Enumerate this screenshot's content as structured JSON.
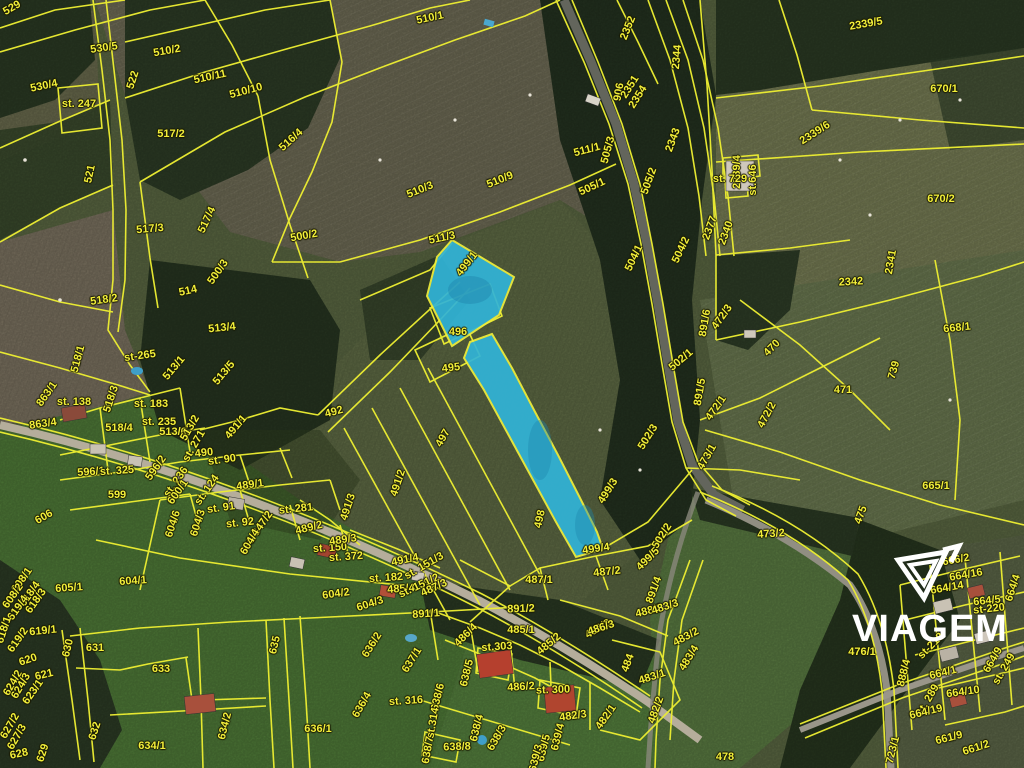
{
  "map": {
    "type": "cadastral-parcel-satellite-view",
    "watermark": {
      "brand": "VIAGEM",
      "color": "#ffffff"
    },
    "colors": {
      "boundary": "#edee32",
      "label": "#f2ef3a",
      "highlight_fill": "#31b4d8",
      "highlight_stroke": "#f0ef3c"
    },
    "highlighted_parcels": [
      "499/1",
      "499/3"
    ],
    "labels": [
      {
        "t": "529",
        "x": 12,
        "y": 8,
        "r": -30
      },
      {
        "t": "530/5",
        "x": 104,
        "y": 48,
        "r": -8
      },
      {
        "t": "510/2",
        "x": 167,
        "y": 51,
        "r": -10
      },
      {
        "t": "530/4",
        "x": 44,
        "y": 86,
        "r": -12
      },
      {
        "t": "st. 247",
        "x": 79,
        "y": 104,
        "r": 0
      },
      {
        "t": "522",
        "x": 133,
        "y": 80,
        "r": -72
      },
      {
        "t": "510/11",
        "x": 210,
        "y": 77,
        "r": -12
      },
      {
        "t": "510/10",
        "x": 246,
        "y": 91,
        "r": -15
      },
      {
        "t": "517/2",
        "x": 171,
        "y": 134,
        "r": 0
      },
      {
        "t": "516/4",
        "x": 291,
        "y": 140,
        "r": -42
      },
      {
        "t": "521",
        "x": 90,
        "y": 174,
        "r": -78
      },
      {
        "t": "517/3",
        "x": 150,
        "y": 229,
        "r": -5
      },
      {
        "t": "517/4",
        "x": 207,
        "y": 220,
        "r": -65
      },
      {
        "t": "500/2",
        "x": 304,
        "y": 236,
        "r": -10
      },
      {
        "t": "510/1",
        "x": 430,
        "y": 18,
        "r": -12
      },
      {
        "t": "2352",
        "x": 628,
        "y": 28,
        "r": -68
      },
      {
        "t": "906",
        "x": 619,
        "y": 92,
        "r": -80
      },
      {
        "t": "2351",
        "x": 630,
        "y": 87,
        "r": -58
      },
      {
        "t": "2354",
        "x": 638,
        "y": 97,
        "r": -58
      },
      {
        "t": "2344",
        "x": 677,
        "y": 57,
        "r": -85
      },
      {
        "t": "2343",
        "x": 673,
        "y": 140,
        "r": -70
      },
      {
        "t": "2339/5",
        "x": 866,
        "y": 24,
        "r": -10
      },
      {
        "t": "670/1",
        "x": 944,
        "y": 89,
        "r": 0
      },
      {
        "t": "2339/6",
        "x": 815,
        "y": 133,
        "r": -33
      },
      {
        "t": "2339/4",
        "x": 737,
        "y": 172,
        "r": -90
      },
      {
        "t": "st. 729",
        "x": 730,
        "y": 179,
        "r": 0
      },
      {
        "t": "st.646",
        "x": 753,
        "y": 180,
        "r": -90
      },
      {
        "t": "670/2",
        "x": 941,
        "y": 199,
        "r": 0
      },
      {
        "t": "510/3",
        "x": 420,
        "y": 190,
        "r": -22
      },
      {
        "t": "510/9",
        "x": 500,
        "y": 180,
        "r": -22
      },
      {
        "t": "511/3",
        "x": 442,
        "y": 238,
        "r": -12
      },
      {
        "t": "511/1",
        "x": 587,
        "y": 150,
        "r": -15
      },
      {
        "t": "505/3",
        "x": 608,
        "y": 150,
        "r": -75
      },
      {
        "t": "505/1",
        "x": 592,
        "y": 187,
        "r": -25
      },
      {
        "t": "505/2",
        "x": 649,
        "y": 181,
        "r": -70
      },
      {
        "t": "504/1",
        "x": 634,
        "y": 258,
        "r": -65
      },
      {
        "t": "504/2",
        "x": 681,
        "y": 250,
        "r": -65
      },
      {
        "t": "2377",
        "x": 710,
        "y": 228,
        "r": -70
      },
      {
        "t": "2340",
        "x": 726,
        "y": 233,
        "r": -70
      },
      {
        "t": "2341",
        "x": 891,
        "y": 262,
        "r": -80
      },
      {
        "t": "2342",
        "x": 851,
        "y": 282,
        "r": -3
      },
      {
        "t": "518/2",
        "x": 104,
        "y": 300,
        "r": -8
      },
      {
        "t": "500/3",
        "x": 218,
        "y": 272,
        "r": -55
      },
      {
        "t": "514",
        "x": 188,
        "y": 291,
        "r": -12
      },
      {
        "t": "513/4",
        "x": 222,
        "y": 328,
        "r": -6
      },
      {
        "t": "518/1",
        "x": 78,
        "y": 359,
        "r": -75
      },
      {
        "t": "st-265",
        "x": 140,
        "y": 356,
        "r": -8
      },
      {
        "t": "513/1",
        "x": 174,
        "y": 368,
        "r": -50
      },
      {
        "t": "513/5",
        "x": 224,
        "y": 373,
        "r": -50
      },
      {
        "t": "863/1",
        "x": 47,
        "y": 394,
        "r": -55
      },
      {
        "t": "st. 138",
        "x": 74,
        "y": 402,
        "r": 0
      },
      {
        "t": "518/3",
        "x": 111,
        "y": 399,
        "r": -72
      },
      {
        "t": "st. 183",
        "x": 151,
        "y": 404,
        "r": 0
      },
      {
        "t": "st. 235",
        "x": 159,
        "y": 422,
        "r": 0
      },
      {
        "t": "863/4",
        "x": 43,
        "y": 424,
        "r": -8
      },
      {
        "t": "518/4",
        "x": 119,
        "y": 428,
        "r": 0
      },
      {
        "t": "513/6",
        "x": 173,
        "y": 432,
        "r": 0
      },
      {
        "t": "513/2",
        "x": 190,
        "y": 428,
        "r": -60
      },
      {
        "t": "st. 271",
        "x": 194,
        "y": 446,
        "r": -60
      },
      {
        "t": "490",
        "x": 204,
        "y": 453,
        "r": -6
      },
      {
        "t": "st. 90",
        "x": 222,
        "y": 460,
        "r": -8
      },
      {
        "t": "491/1",
        "x": 236,
        "y": 427,
        "r": -50
      },
      {
        "t": "492",
        "x": 334,
        "y": 412,
        "r": -15
      },
      {
        "t": "496",
        "x": 458,
        "y": 332,
        "r": 0
      },
      {
        "t": "495",
        "x": 451,
        "y": 368,
        "r": -6
      },
      {
        "t": "497",
        "x": 443,
        "y": 438,
        "r": -60
      },
      {
        "t": "499/1",
        "x": 467,
        "y": 264,
        "r": -52
      },
      {
        "t": "491/2",
        "x": 398,
        "y": 483,
        "r": -72
      },
      {
        "t": "491/3",
        "x": 348,
        "y": 507,
        "r": -72
      },
      {
        "t": "498",
        "x": 540,
        "y": 519,
        "r": -78
      },
      {
        "t": "499/3",
        "x": 608,
        "y": 491,
        "r": -58
      },
      {
        "t": "502/3",
        "x": 648,
        "y": 437,
        "r": -58
      },
      {
        "t": "502/1",
        "x": 681,
        "y": 360,
        "r": -40
      },
      {
        "t": "502/2",
        "x": 662,
        "y": 536,
        "r": -58
      },
      {
        "t": "891/6",
        "x": 705,
        "y": 323,
        "r": -80
      },
      {
        "t": "891/5",
        "x": 700,
        "y": 392,
        "r": -80
      },
      {
        "t": "470",
        "x": 772,
        "y": 348,
        "r": -45
      },
      {
        "t": "471",
        "x": 843,
        "y": 390,
        "r": 0
      },
      {
        "t": "472/3",
        "x": 722,
        "y": 317,
        "r": -55
      },
      {
        "t": "472/1",
        "x": 716,
        "y": 408,
        "r": -55
      },
      {
        "t": "472/2",
        "x": 767,
        "y": 415,
        "r": -62
      },
      {
        "t": "473/1",
        "x": 707,
        "y": 457,
        "r": -60
      },
      {
        "t": "739",
        "x": 894,
        "y": 370,
        "r": -75
      },
      {
        "t": "668/1",
        "x": 957,
        "y": 328,
        "r": -6
      },
      {
        "t": "665/1",
        "x": 936,
        "y": 486,
        "r": 0
      },
      {
        "t": "473/2",
        "x": 771,
        "y": 534,
        "r": -4
      },
      {
        "t": "475",
        "x": 861,
        "y": 515,
        "r": -70
      },
      {
        "t": "476/1",
        "x": 862,
        "y": 652,
        "r": 0
      },
      {
        "t": "478",
        "x": 725,
        "y": 757,
        "r": 0
      },
      {
        "t": "499/4",
        "x": 596,
        "y": 549,
        "r": -8
      },
      {
        "t": "499/5",
        "x": 648,
        "y": 559,
        "r": -45
      },
      {
        "t": "487/2",
        "x": 607,
        "y": 572,
        "r": -6
      },
      {
        "t": "487/1",
        "x": 539,
        "y": 580,
        "r": 0
      },
      {
        "t": "891/2",
        "x": 521,
        "y": 609,
        "r": -2
      },
      {
        "t": "891/4",
        "x": 654,
        "y": 590,
        "r": -70
      },
      {
        "t": "488/2",
        "x": 649,
        "y": 611,
        "r": -14
      },
      {
        "t": "483/3",
        "x": 665,
        "y": 607,
        "r": -18
      },
      {
        "t": "488/3",
        "x": 598,
        "y": 629,
        "r": -30
      },
      {
        "t": "485/1",
        "x": 521,
        "y": 630,
        "r": 0
      },
      {
        "t": "485/2",
        "x": 549,
        "y": 644,
        "r": -40
      },
      {
        "t": "486/3",
        "x": 601,
        "y": 628,
        "r": -18
      },
      {
        "t": "484",
        "x": 628,
        "y": 663,
        "r": -70
      },
      {
        "t": "483/1",
        "x": 652,
        "y": 677,
        "r": -18
      },
      {
        "t": "483/2",
        "x": 686,
        "y": 637,
        "r": -28
      },
      {
        "t": "483/4",
        "x": 689,
        "y": 658,
        "r": -58
      },
      {
        "t": "482/1",
        "x": 606,
        "y": 717,
        "r": -55
      },
      {
        "t": "482/3",
        "x": 573,
        "y": 716,
        "r": -8
      },
      {
        "t": "482/2",
        "x": 656,
        "y": 710,
        "r": -70
      },
      {
        "t": "486/4",
        "x": 466,
        "y": 635,
        "r": -45
      },
      {
        "t": "st.303",
        "x": 497,
        "y": 647,
        "r": -4
      },
      {
        "t": "486/2",
        "x": 521,
        "y": 687,
        "r": -4
      },
      {
        "t": "st. 300",
        "x": 553,
        "y": 690,
        "r": -2
      },
      {
        "t": "638/5",
        "x": 467,
        "y": 673,
        "r": -76
      },
      {
        "t": "638/6",
        "x": 438,
        "y": 697,
        "r": -76
      },
      {
        "t": "st.314",
        "x": 433,
        "y": 723,
        "r": -80
      },
      {
        "t": "638/4",
        "x": 477,
        "y": 728,
        "r": -76
      },
      {
        "t": "638/3",
        "x": 497,
        "y": 738,
        "r": -60
      },
      {
        "t": "638/8",
        "x": 457,
        "y": 747,
        "r": -2
      },
      {
        "t": "638/7",
        "x": 428,
        "y": 750,
        "r": -80
      },
      {
        "t": "639/4",
        "x": 558,
        "y": 737,
        "r": -76
      },
      {
        "t": "639/5",
        "x": 544,
        "y": 748,
        "r": -76
      },
      {
        "t": "639/3",
        "x": 536,
        "y": 758,
        "r": -76
      },
      {
        "t": "st. 316",
        "x": 406,
        "y": 701,
        "r": -4
      },
      {
        "t": "636/2",
        "x": 372,
        "y": 645,
        "r": -58
      },
      {
        "t": "637/1",
        "x": 412,
        "y": 660,
        "r": -58
      },
      {
        "t": "636/4",
        "x": 362,
        "y": 705,
        "r": -60
      },
      {
        "t": "604/2",
        "x": 336,
        "y": 594,
        "r": -8
      },
      {
        "t": "604/3",
        "x": 370,
        "y": 604,
        "r": -18
      },
      {
        "t": "891/1",
        "x": 426,
        "y": 614,
        "r": -4
      },
      {
        "t": "st. 182",
        "x": 386,
        "y": 578,
        "r": -4
      },
      {
        "t": "485/4",
        "x": 401,
        "y": 589,
        "r": -4
      },
      {
        "t": "st. 151/2",
        "x": 419,
        "y": 586,
        "r": -25
      },
      {
        "t": "487/3",
        "x": 434,
        "y": 588,
        "r": -25
      },
      {
        "t": "st. 372",
        "x": 346,
        "y": 557,
        "r": -4
      },
      {
        "t": "st. 150",
        "x": 330,
        "y": 548,
        "r": -4
      },
      {
        "t": "489/3",
        "x": 343,
        "y": 540,
        "r": -8
      },
      {
        "t": "489/2",
        "x": 309,
        "y": 528,
        "r": -14
      },
      {
        "t": "st. 281",
        "x": 296,
        "y": 509,
        "r": -6
      },
      {
        "t": "491/4",
        "x": 405,
        "y": 560,
        "r": -12
      },
      {
        "t": "st. 151/3",
        "x": 424,
        "y": 566,
        "r": -30
      },
      {
        "t": "489/1",
        "x": 250,
        "y": 485,
        "r": -8
      },
      {
        "t": "596/1",
        "x": 91,
        "y": 472,
        "r": -4
      },
      {
        "t": "st. 325",
        "x": 117,
        "y": 471,
        "r": -4
      },
      {
        "t": "596/2",
        "x": 156,
        "y": 468,
        "r": -55
      },
      {
        "t": "599",
        "x": 117,
        "y": 495,
        "r": 0
      },
      {
        "t": "st. 236",
        "x": 176,
        "y": 482,
        "r": -55
      },
      {
        "t": "600/1",
        "x": 178,
        "y": 492,
        "r": -55
      },
      {
        "t": "st. 124",
        "x": 207,
        "y": 490,
        "r": -55
      },
      {
        "t": "st. 91",
        "x": 221,
        "y": 508,
        "r": -8
      },
      {
        "t": "st. 92",
        "x": 240,
        "y": 523,
        "r": -6
      },
      {
        "t": "st. 347/2",
        "x": 258,
        "y": 530,
        "r": -55
      },
      {
        "t": "604/4",
        "x": 250,
        "y": 542,
        "r": -60
      },
      {
        "t": "604/6",
        "x": 173,
        "y": 524,
        "r": -72
      },
      {
        "t": "604/3",
        "x": 198,
        "y": 523,
        "r": -72
      },
      {
        "t": "606",
        "x": 44,
        "y": 517,
        "r": -30
      },
      {
        "t": "605/1",
        "x": 69,
        "y": 588,
        "r": -4
      },
      {
        "t": "604/1",
        "x": 133,
        "y": 581,
        "r": -4
      },
      {
        "t": "608/1",
        "x": 22,
        "y": 580,
        "r": -55
      },
      {
        "t": "608/2",
        "x": 13,
        "y": 596,
        "r": -55
      },
      {
        "t": "618/4",
        "x": 30,
        "y": 594,
        "r": -55
      },
      {
        "t": "618/3",
        "x": 36,
        "y": 601,
        "r": -55
      },
      {
        "t": "619/4",
        "x": 18,
        "y": 608,
        "r": -55
      },
      {
        "t": "618/1",
        "x": 4,
        "y": 630,
        "r": -72
      },
      {
        "t": "619/1",
        "x": 43,
        "y": 631,
        "r": -6
      },
      {
        "t": "619/2",
        "x": 18,
        "y": 640,
        "r": -55
      },
      {
        "t": "620",
        "x": 28,
        "y": 660,
        "r": -18
      },
      {
        "t": "621",
        "x": 44,
        "y": 675,
        "r": -14
      },
      {
        "t": "624/2",
        "x": 13,
        "y": 683,
        "r": -60
      },
      {
        "t": "624/3",
        "x": 21,
        "y": 686,
        "r": -60
      },
      {
        "t": "623/1",
        "x": 33,
        "y": 692,
        "r": -55
      },
      {
        "t": "627/2",
        "x": 10,
        "y": 726,
        "r": -60
      },
      {
        "t": "627/3",
        "x": 17,
        "y": 737,
        "r": -60
      },
      {
        "t": "628",
        "x": 19,
        "y": 754,
        "r": -12
      },
      {
        "t": "629",
        "x": 43,
        "y": 753,
        "r": -72
      },
      {
        "t": "630",
        "x": 68,
        "y": 648,
        "r": -76
      },
      {
        "t": "631",
        "x": 95,
        "y": 648,
        "r": 0
      },
      {
        "t": "632",
        "x": 95,
        "y": 731,
        "r": -72
      },
      {
        "t": "633",
        "x": 161,
        "y": 669,
        "r": 0
      },
      {
        "t": "634/1",
        "x": 152,
        "y": 746,
        "r": 0
      },
      {
        "t": "634/2",
        "x": 225,
        "y": 726,
        "r": -76
      },
      {
        "t": "635",
        "x": 275,
        "y": 645,
        "r": -76
      },
      {
        "t": "636/1",
        "x": 318,
        "y": 729,
        "r": 0
      },
      {
        "t": "664/1",
        "x": 943,
        "y": 673,
        "r": -14
      },
      {
        "t": "664/10",
        "x": 963,
        "y": 692,
        "r": -8
      },
      {
        "t": "st. 289",
        "x": 928,
        "y": 700,
        "r": -60
      },
      {
        "t": "664/19",
        "x": 926,
        "y": 712,
        "r": -14
      },
      {
        "t": "661/9",
        "x": 949,
        "y": 738,
        "r": -14
      },
      {
        "t": "661/2",
        "x": 976,
        "y": 748,
        "r": -18
      },
      {
        "t": "723/1",
        "x": 893,
        "y": 750,
        "r": -76
      },
      {
        "t": "888/4",
        "x": 904,
        "y": 673,
        "r": -76
      },
      {
        "t": "664/9",
        "x": 993,
        "y": 660,
        "r": -60
      },
      {
        "t": "st. 249",
        "x": 1004,
        "y": 669,
        "r": -60
      },
      {
        "t": "664/16",
        "x": 966,
        "y": 575,
        "r": -10
      },
      {
        "t": "664/14",
        "x": 947,
        "y": 588,
        "r": -10
      },
      {
        "t": "666/2",
        "x": 956,
        "y": 560,
        "r": -10
      },
      {
        "t": "664/5",
        "x": 987,
        "y": 601,
        "r": -6
      },
      {
        "t": "st-220",
        "x": 989,
        "y": 609,
        "r": -6
      },
      {
        "t": "664/4",
        "x": 1013,
        "y": 588,
        "r": -72
      },
      {
        "t": "st-218",
        "x": 931,
        "y": 646,
        "r": -45
      }
    ]
  }
}
